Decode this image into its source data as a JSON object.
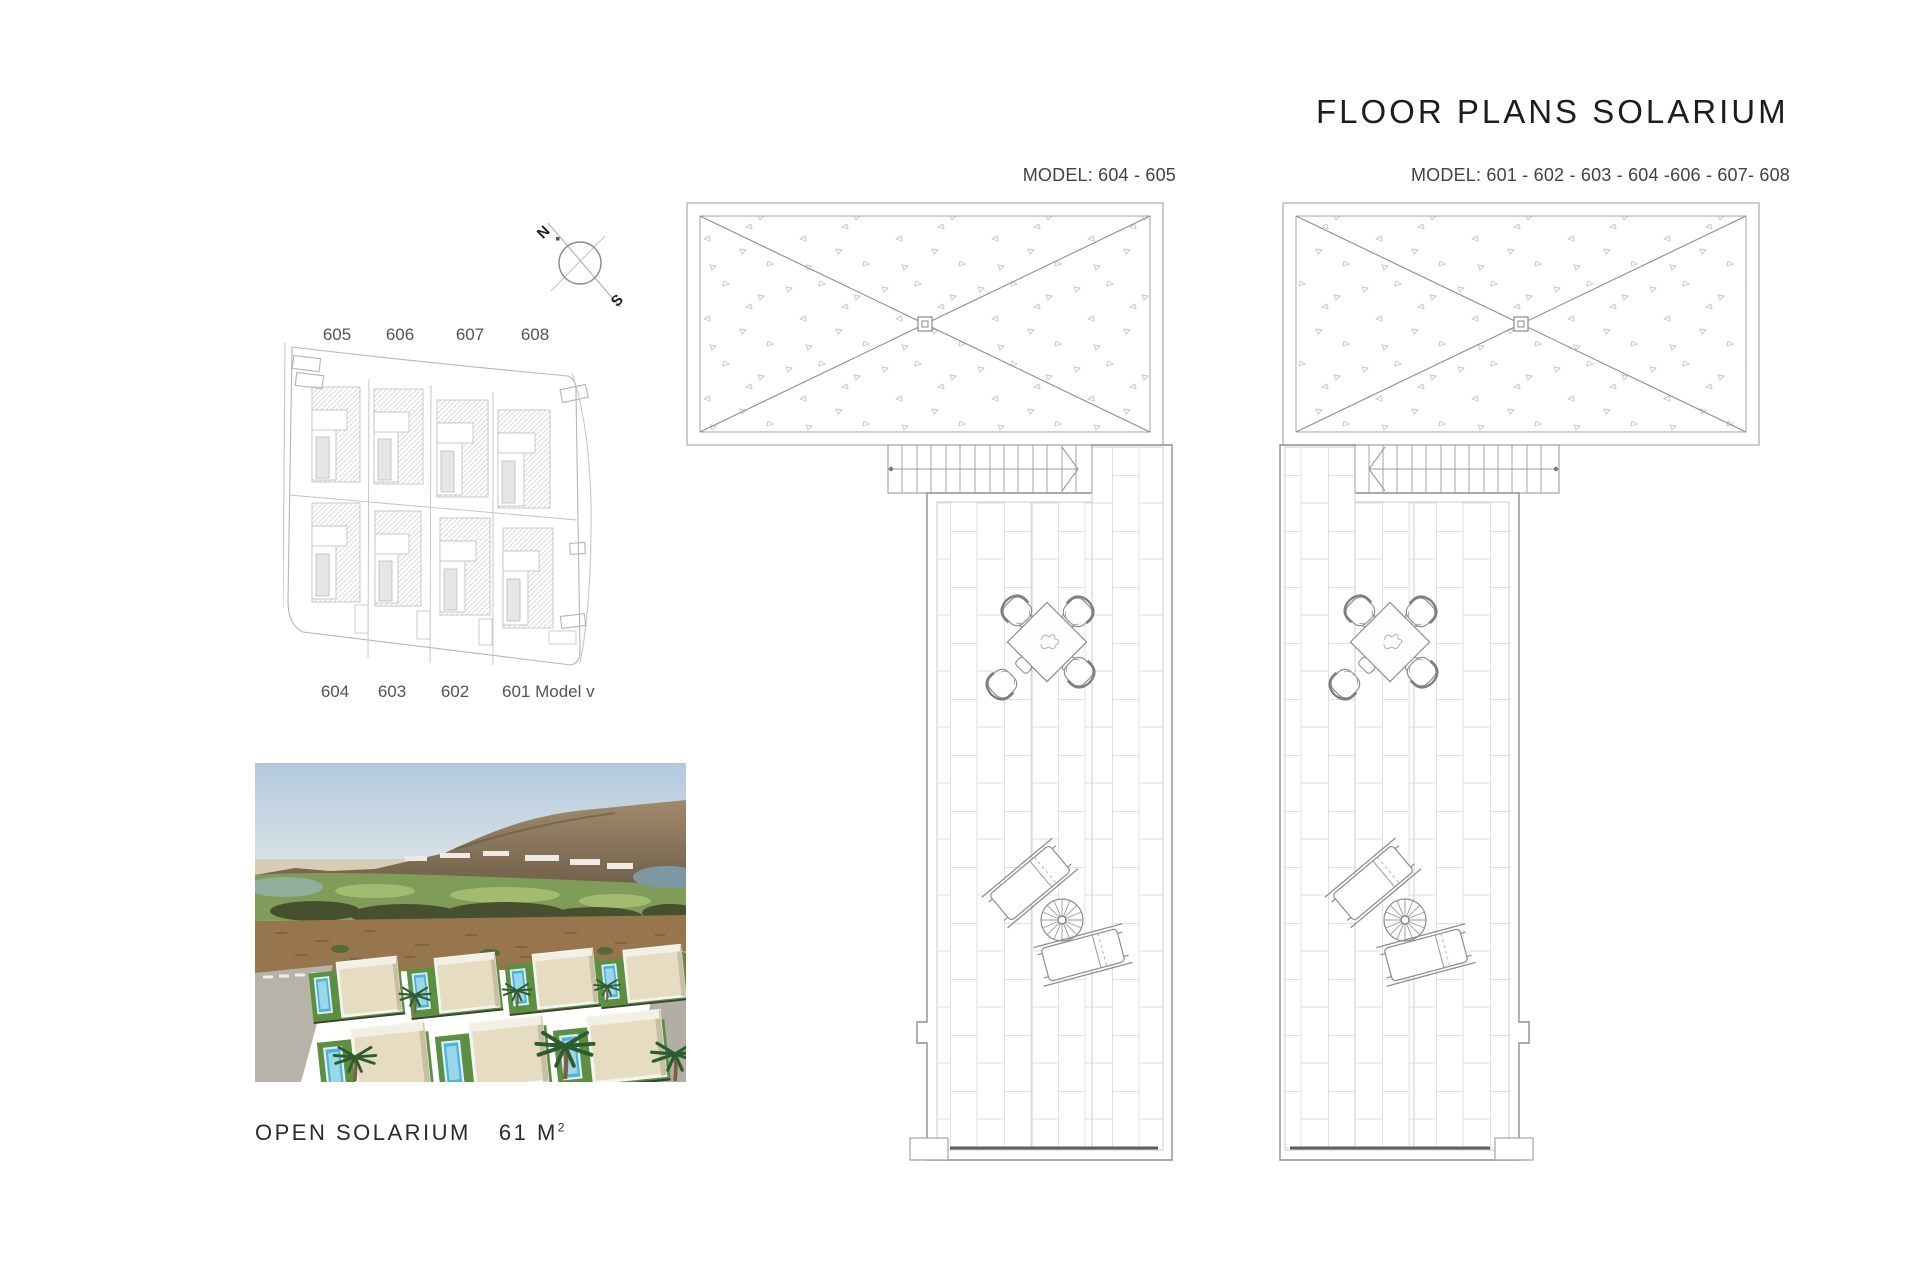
{
  "page": {
    "title": "FLOOR PLANS SOLARIUM"
  },
  "plans": {
    "left": {
      "model_label": "MODEL:  604 - 605"
    },
    "right": {
      "model_label": "MODEL: 601 - 602 - 603 - 604 -606 - 607- 608"
    }
  },
  "compass": {
    "north_label": "N",
    "south_label": "S"
  },
  "site_plan": {
    "top_labels": [
      "605",
      "606",
      "607",
      "608"
    ],
    "bottom_labels": [
      "604",
      "603",
      "602",
      "601 Model villa"
    ]
  },
  "solarium": {
    "name": "OPEN SOLARIUM",
    "area": "61 M",
    "area_sup": "2"
  },
  "colors": {
    "text-dark": "#1d1d1d",
    "text-gray": "#474747",
    "line": "#9a9a9a"
  }
}
